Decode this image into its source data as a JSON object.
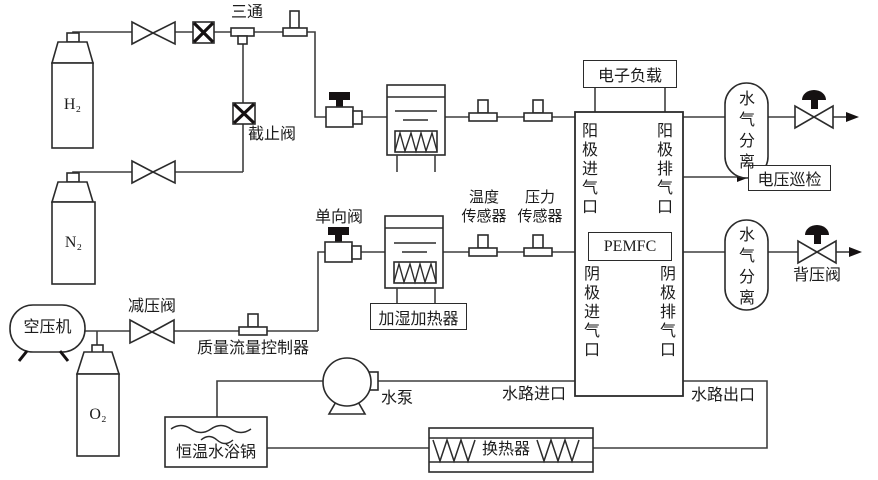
{
  "diagram": {
    "gas_supply": {
      "h2_cylinder": "H₂",
      "n2_cylinder": "N₂",
      "o2_cylinder": "O₂",
      "air_compressor": "空压机"
    },
    "valves_fittings": {
      "tee": "三通",
      "shutoff_valve": "截止阀",
      "check_valve": "单向阀",
      "pressure_reducing_valve": "减压阀",
      "back_pressure_valve": "背压阀",
      "mass_flow_controller": "质量流量控制器"
    },
    "sensors": {
      "temperature": [
        "温度",
        "传感器"
      ],
      "pressure": [
        "压力",
        "传感器"
      ]
    },
    "humidifier_heater": "加湿加热器",
    "fuel_cell": {
      "stack": "PEMFC",
      "anode_inlet": "阳极进气口",
      "anode_outlet": "阳极排气口",
      "cathode_inlet": "阴极进气口",
      "cathode_outlet": "阴极排气口"
    },
    "electrical": {
      "electronic_load": "电子负载",
      "voltage_monitor": "电压巡检"
    },
    "separators": {
      "anode": "水气分离",
      "cathode": "水气分离"
    },
    "water_loop": {
      "pump": "水泵",
      "water_inlet": "水路进口",
      "water_outlet": "水路出口",
      "water_bath": "恒温水浴锅",
      "heat_exchanger": "换热器"
    },
    "colors": {
      "line": "#3f3f3f",
      "symbol": "#2b2b2b",
      "solid": "#151112",
      "background": "#ffffff"
    }
  }
}
